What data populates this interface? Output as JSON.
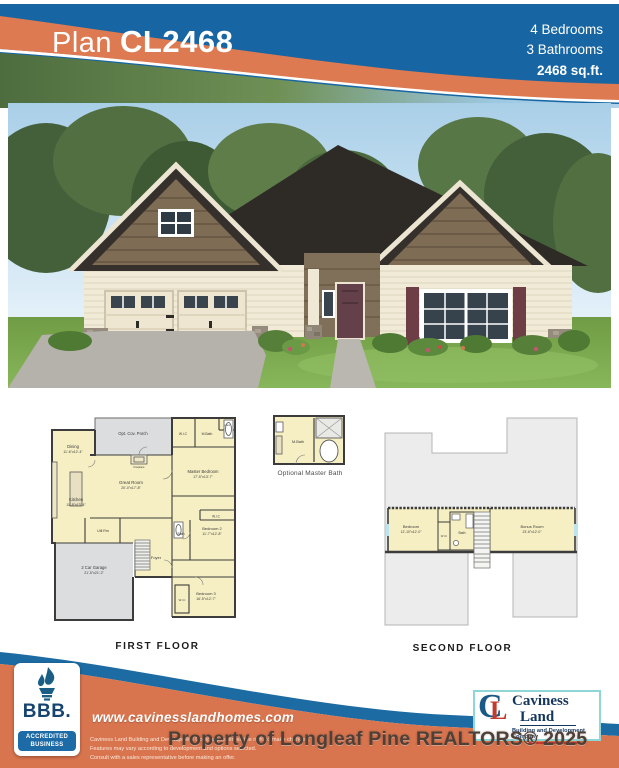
{
  "header": {
    "plan_label": "Plan",
    "plan_code": "CL2468",
    "bedrooms": "4 Bedrooms",
    "bathrooms": "3 Bathrooms",
    "sqft": "2468 sq.ft."
  },
  "colors": {
    "header_blue": "#1766a3",
    "swoosh_orange": "#dd7a52",
    "footer_orange": "#d8744e",
    "footer_blue": "#1d6ba3",
    "plan_yellow": "#f6efc3",
    "plan_gray": "#dcdddf"
  },
  "first_floor": {
    "caption": "FIRST FLOOR",
    "rooms": {
      "porch": "Opt. Cov. Porch",
      "dining": {
        "name": "Dining",
        "dims": "11'-6\"x12'-4\""
      },
      "fireplace": "Fireplace",
      "great": {
        "name": "Great Room",
        "dims": "20'-0\"x17'-8\""
      },
      "kitchen": {
        "name": "Kitchen",
        "dims": "11'-8\"x13'-4\""
      },
      "util": "Util Rm",
      "wic1": "W.I.C",
      "mbath": "M.Bath",
      "linen": "Linen",
      "master": {
        "name": "Master Bedroom",
        "dims": "17'-5\"x13'-7\""
      },
      "wic2": "W.I.C",
      "bath": "Bath",
      "bedroom2": {
        "name": "Bedroom 2",
        "dims": "11'-7\"x12'-8\""
      },
      "foyer": "Foyer",
      "garage": {
        "name": "2 Car Garage",
        "dims": "21'-5\"x21'-2\""
      },
      "bedroom3": {
        "name": "Bedroom 3",
        "dims": "16'-5\"x12'-7\""
      },
      "wic3": "W.I.C"
    }
  },
  "optional_bath": {
    "caption": "Optional Master Bath",
    "label": "M.Bath"
  },
  "second_floor": {
    "caption": "SECOND FLOOR",
    "rooms": {
      "bedroom": {
        "name": "Bedroom",
        "dims": "12'-10\"x12'-0\""
      },
      "wic": "W.I.C",
      "bath": "Bath",
      "bonus": {
        "name": "Bonus Room",
        "dims": "23'-6\"x12'-0\""
      }
    }
  },
  "footer": {
    "website": "www.cavinesslandhomes.com",
    "disclaimer_lines": [
      "Caviness Land Building and Development Company reserves the right to make changes.",
      "Features may vary according to development and options selected.",
      "Consult with a sales representative before making an offer."
    ],
    "bbb": {
      "label": "BBB.",
      "line1": "ACCREDITED",
      "line2": "BUSINESS"
    },
    "caviness": {
      "name1": "Caviness",
      "name2": "Land",
      "tagline": "Building and Development Company"
    }
  },
  "watermark": "Property of Longleaf Pine REALTORS® 2025"
}
